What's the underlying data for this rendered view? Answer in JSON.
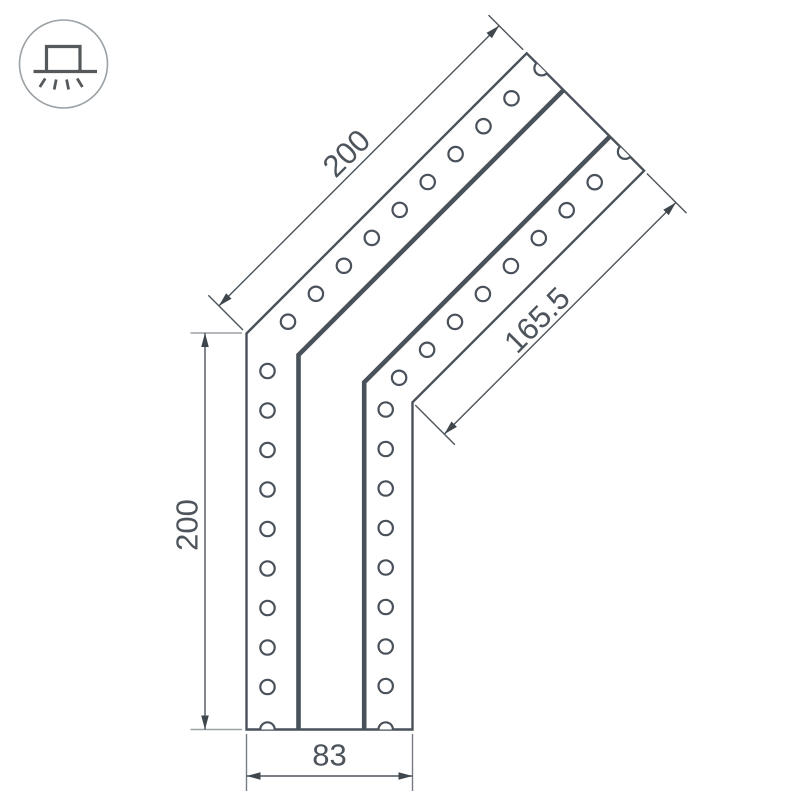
{
  "drawing": {
    "type": "technical-drawing-led-profile-corner",
    "icon": "recessed-downlight-icon",
    "dimensions": {
      "diagonal_length": "200",
      "vertical_length": "200",
      "inner_diagonal_length": "165.5",
      "bottom_width": "83"
    },
    "colors": {
      "profile_line": "#49515a",
      "dimension_line": "#4d555c",
      "extension_light": "#9ba1a5",
      "text": "#4d545b",
      "background": "#ffffff"
    }
  }
}
